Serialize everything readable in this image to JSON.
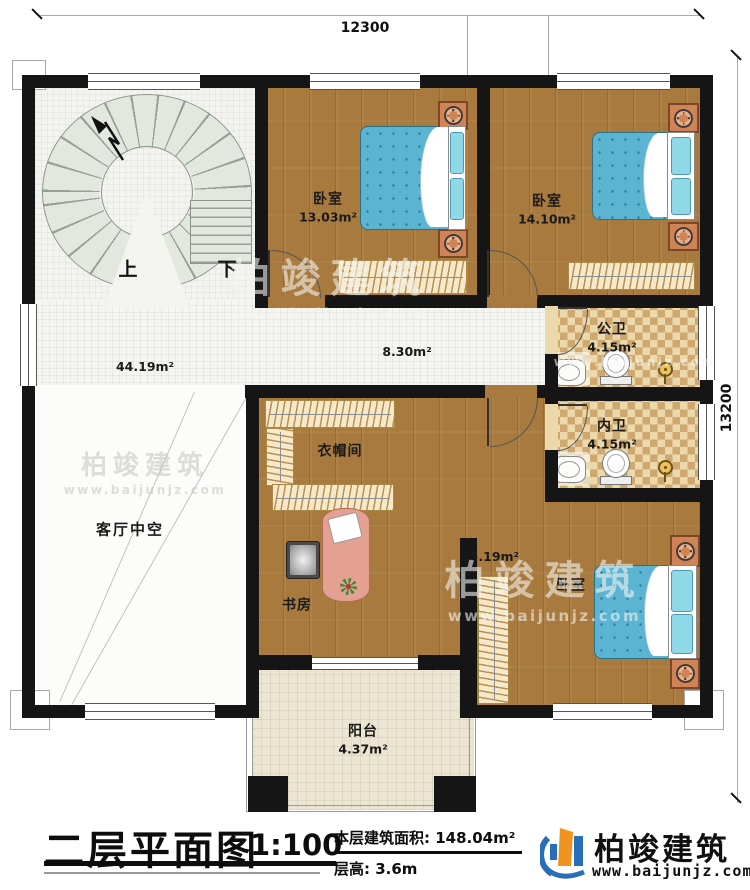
{
  "dimensions": {
    "width_mm": "12300",
    "height_mm": "13200"
  },
  "rooms": {
    "bedroom1": {
      "label": "卧室",
      "area": "13.03m²"
    },
    "bedroom2": {
      "label": "卧室",
      "area": "14.10m²"
    },
    "public_bath": {
      "label": "公卫",
      "area": "4.15m²"
    },
    "inner_bath": {
      "label": "内卫",
      "area": "4.15m²"
    },
    "hall": {
      "area": "44.19m²"
    },
    "corridor": {
      "area": "8.30m²"
    },
    "cloakroom": {
      "label": "衣帽间"
    },
    "study": {
      "label": "书房"
    },
    "master_bedroom": {
      "label": "卧室",
      "area": "35.19m²"
    },
    "living_void": {
      "label": "客厅中空"
    },
    "balcony": {
      "label": "阳台",
      "area": "4.37m²"
    },
    "stairs": {
      "up": "上",
      "down": "下"
    }
  },
  "title_block": {
    "title": "二层平面图",
    "scale": "1:100",
    "floor_area_label": "本层建筑面积:",
    "floor_area_value": "148.04m²",
    "floor_height_label": "层高:",
    "floor_height_value": "3.6m"
  },
  "brand": {
    "name": "柏竣建筑",
    "website": "www.baijunjz.com"
  },
  "watermark": {
    "name": "柏竣建筑",
    "website": "www.baijunjz.com"
  }
}
